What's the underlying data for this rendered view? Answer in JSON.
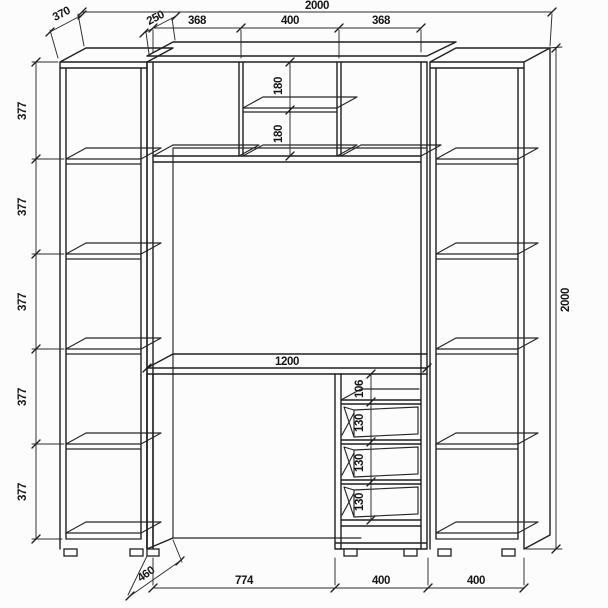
{
  "page": {
    "background": "#fcfcfc",
    "line_color": "#1f1f1f",
    "dim_color": "#161616"
  },
  "dims": {
    "left_depth": "370",
    "hutch_depth": "250",
    "overall_width": "2000",
    "hutch_sections": [
      "368",
      "400",
      "368"
    ],
    "left_shelves": [
      "377",
      "377",
      "377",
      "377",
      "377"
    ],
    "overall_height": "2000",
    "hutch_shelf": [
      "180",
      "180"
    ],
    "desk_width": "1200",
    "drawer_stack": [
      "106",
      "130",
      "130",
      "130"
    ],
    "desk_depth": "460",
    "kneehole_width": "774",
    "drawer_unit_width": "400",
    "right_case_width": "400"
  }
}
